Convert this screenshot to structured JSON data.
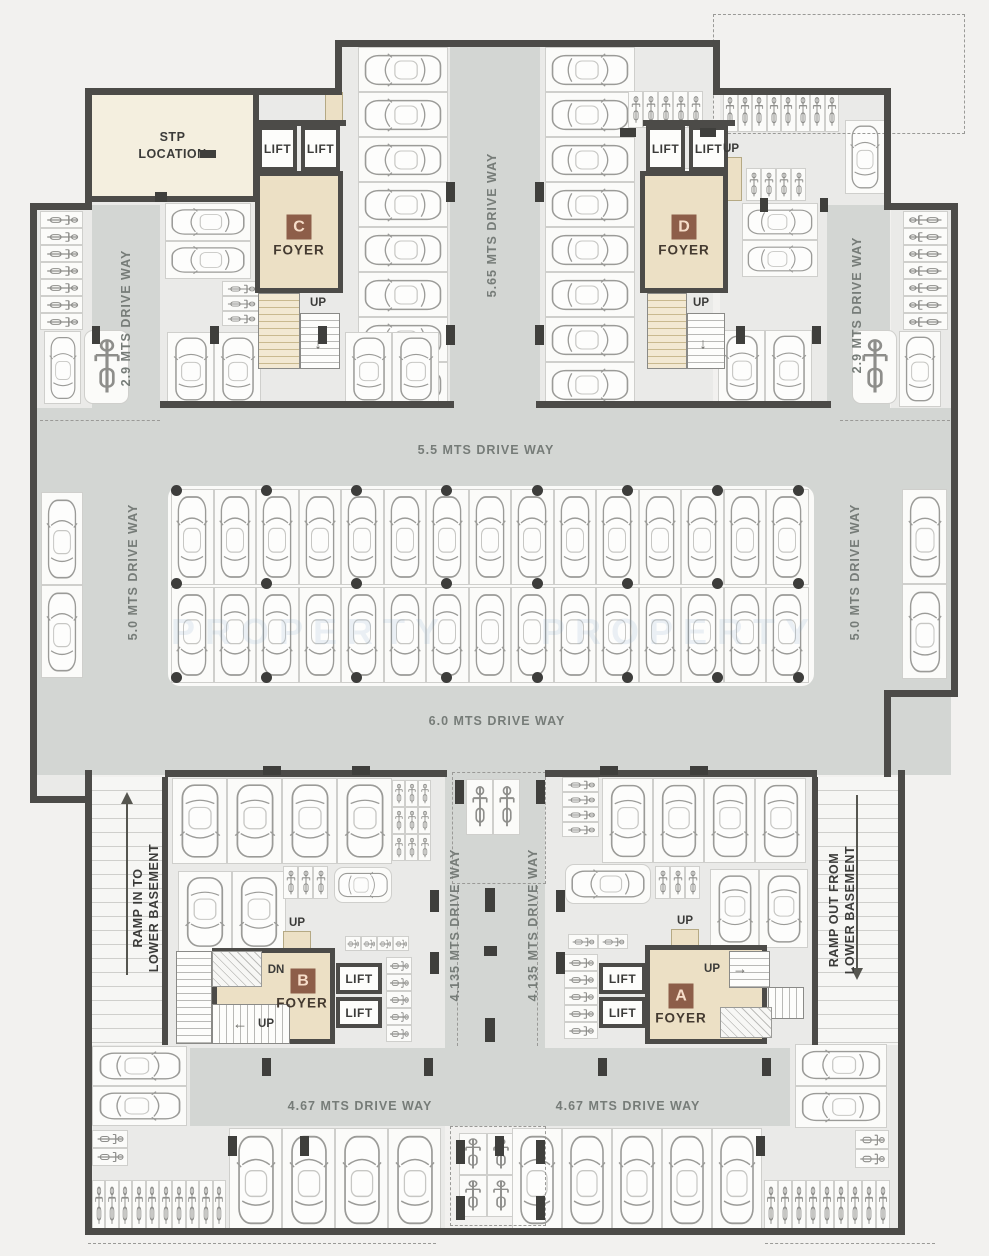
{
  "labels": {
    "stp_line1": "STP",
    "stp_line2": "LOCATION",
    "lift": "LIFT",
    "up": "UP",
    "dn": "DN",
    "foyer": "FOYER",
    "badges": {
      "a": "A",
      "b": "B",
      "c": "C",
      "d": "D"
    },
    "driveways": {
      "d565": "5.65 MTS DRIVE WAY",
      "d29_left": "2.9 MTS DRIVE WAY",
      "d29_right": "2.9 MTS DRIVE WAY",
      "d55": "5.5 MTS DRIVE WAY",
      "d50_left": "5.0 MTS DRIVE WAY",
      "d50_right": "5.0 MTS DRIVE WAY",
      "d60": "6.0 MTS DRIVE WAY",
      "d4135_left": "4.135 MTS DRIVE WAY",
      "d4135_right": "4.135 MTS DRIVE WAY",
      "d467_left": "4.67 MTS DRIVE WAY",
      "d467_right": "4.67 MTS DRIVE WAY"
    },
    "ramp_in": {
      "line1": "RAMP IN TO",
      "line2": "LOWER BASEMENT"
    },
    "ramp_out": {
      "line1": "RAMP OUT FROM",
      "line2": "LOWER BASEMENT"
    },
    "watermark": "PROPERTY"
  },
  "icons": {
    "arrow_up": "↑",
    "arrow_down": "↓",
    "arrow_left": "←",
    "arrow_right": "→"
  },
  "colors": {
    "wall": "#4c4b48",
    "driveway": "#d3d6d3",
    "foyer": "#ece0c5",
    "badge": "#8d5e49",
    "floor": "#eaeae8",
    "stall": "#fbfbf9",
    "driveway_text": "#767c78",
    "label_text": "#3b3b39"
  },
  "parking": [
    {
      "x": 358,
      "y": 47,
      "cols": 1,
      "rows": 8,
      "w": 90,
      "h": 45,
      "icon": "car",
      "rot": 270
    },
    {
      "x": 545,
      "y": 47,
      "cols": 1,
      "rows": 8,
      "w": 90,
      "h": 45,
      "icon": "car",
      "rot": 90
    },
    {
      "x": 628,
      "y": 91,
      "cols": 5,
      "rows": 1,
      "w": 15,
      "h": 37,
      "icon": "bike",
      "rot": 0
    },
    {
      "x": 646,
      "y": 168,
      "cols": 4,
      "rows": 1,
      "w": 15,
      "h": 33,
      "icon": "bike",
      "rot": 0
    },
    {
      "x": 165,
      "y": 203,
      "cols": 1,
      "rows": 2,
      "w": 86,
      "h": 38,
      "icon": "car",
      "rot": 270
    },
    {
      "x": 222,
      "y": 281,
      "cols": 1,
      "rows": 3,
      "w": 38,
      "h": 15,
      "icon": "bike",
      "rot": 90
    },
    {
      "x": 167,
      "y": 332,
      "cols": 2,
      "rows": 1,
      "w": 47,
      "h": 74,
      "icon": "car",
      "rot": 0
    },
    {
      "x": 345,
      "y": 332,
      "cols": 2,
      "rows": 1,
      "w": 47,
      "h": 74,
      "icon": "car",
      "rot": 0
    },
    {
      "x": 40,
      "y": 211,
      "cols": 1,
      "rows": 7,
      "w": 43,
      "h": 17,
      "icon": "bike",
      "rot": 90
    },
    {
      "x": 44,
      "y": 331,
      "cols": 1,
      "rows": 1,
      "w": 37,
      "h": 73,
      "icon": "car",
      "rot": 0
    },
    {
      "x": 84,
      "y": 330,
      "cols": 1,
      "rows": 1,
      "w": 45,
      "h": 74,
      "icon": "bike",
      "rot": 0,
      "round": true
    },
    {
      "x": 41,
      "y": 492,
      "cols": 1,
      "rows": 2,
      "w": 42,
      "h": 93,
      "icon": "car",
      "rot": 0
    },
    {
      "x": 171,
      "y": 489,
      "cols": 15,
      "rows": 1,
      "w": 42.5,
      "h": 96,
      "icon": "car",
      "rot": 0
    },
    {
      "x": 171,
      "y": 587,
      "cols": 15,
      "rows": 1,
      "w": 42.5,
      "h": 96,
      "icon": "car",
      "rot": 180
    },
    {
      "x": 903,
      "y": 211,
      "cols": 1,
      "rows": 7,
      "w": 45,
      "h": 17,
      "icon": "bike",
      "rot": 270
    },
    {
      "x": 899,
      "y": 331,
      "cols": 1,
      "rows": 1,
      "w": 42,
      "h": 76,
      "icon": "car",
      "rot": 0
    },
    {
      "x": 852,
      "y": 330,
      "cols": 1,
      "rows": 1,
      "w": 45,
      "h": 74,
      "icon": "bike",
      "rot": 0,
      "round": true
    },
    {
      "x": 902,
      "y": 489,
      "cols": 1,
      "rows": 2,
      "w": 45,
      "h": 95,
      "icon": "car",
      "rot": 0
    },
    {
      "x": 723,
      "y": 92,
      "cols": 8,
      "rows": 1,
      "w": 14.5,
      "h": 40,
      "icon": "bike",
      "rot": 0
    },
    {
      "x": 845,
      "y": 120,
      "cols": 1,
      "rows": 1,
      "w": 40,
      "h": 74,
      "icon": "car",
      "rot": 0
    },
    {
      "x": 746,
      "y": 168,
      "cols": 4,
      "rows": 1,
      "w": 15,
      "h": 33,
      "icon": "bike",
      "rot": 0
    },
    {
      "x": 742,
      "y": 203,
      "cols": 1,
      "rows": 2,
      "w": 76,
      "h": 37,
      "icon": "car",
      "rot": 90
    },
    {
      "x": 718,
      "y": 330,
      "cols": 2,
      "rows": 1,
      "w": 47,
      "h": 76,
      "icon": "car",
      "rot": 0
    },
    {
      "x": 172,
      "y": 778,
      "cols": 4,
      "rows": 1,
      "w": 55,
      "h": 86,
      "icon": "car",
      "rot": 180
    },
    {
      "x": 392,
      "y": 780,
      "cols": 3,
      "rows": 3,
      "w": 13,
      "h": 27,
      "icon": "bike",
      "rot": 0
    },
    {
      "x": 178,
      "y": 871,
      "cols": 2,
      "rows": 1,
      "w": 54,
      "h": 82,
      "icon": "car",
      "rot": 180
    },
    {
      "x": 283,
      "y": 866,
      "cols": 3,
      "rows": 1,
      "w": 15,
      "h": 33,
      "icon": "bike",
      "rot": 0
    },
    {
      "x": 334,
      "y": 867,
      "cols": 1,
      "rows": 1,
      "w": 58,
      "h": 36,
      "icon": "car",
      "rot": 90,
      "round": true
    },
    {
      "x": 345,
      "y": 936,
      "cols": 4,
      "rows": 1,
      "w": 16,
      "h": 15,
      "icon": "bike",
      "rot": 90
    },
    {
      "x": 386,
      "y": 957,
      "cols": 1,
      "rows": 5,
      "w": 26,
      "h": 17,
      "icon": "bike",
      "rot": 90
    },
    {
      "x": 466,
      "y": 779,
      "cols": 2,
      "rows": 1,
      "w": 27,
      "h": 56,
      "icon": "bike",
      "rot": 0
    },
    {
      "x": 562,
      "y": 777,
      "cols": 1,
      "rows": 4,
      "w": 37,
      "h": 15,
      "icon": "bike",
      "rot": 90
    },
    {
      "x": 602,
      "y": 778,
      "cols": 4,
      "rows": 1,
      "w": 51,
      "h": 85,
      "icon": "car",
      "rot": 180
    },
    {
      "x": 655,
      "y": 866,
      "cols": 3,
      "rows": 1,
      "w": 15,
      "h": 33,
      "icon": "bike",
      "rot": 0
    },
    {
      "x": 565,
      "y": 864,
      "cols": 1,
      "rows": 1,
      "w": 86,
      "h": 40,
      "icon": "car",
      "rot": 270,
      "round": true
    },
    {
      "x": 710,
      "y": 869,
      "cols": 2,
      "rows": 1,
      "w": 49,
      "h": 79,
      "icon": "car",
      "rot": 180
    },
    {
      "x": 568,
      "y": 934,
      "cols": 2,
      "rows": 1,
      "w": 30,
      "h": 15,
      "icon": "bike",
      "rot": 90
    },
    {
      "x": 564,
      "y": 954,
      "cols": 1,
      "rows": 5,
      "w": 34,
      "h": 17,
      "icon": "bike",
      "rot": 90
    },
    {
      "x": 92,
      "y": 1046,
      "cols": 1,
      "rows": 2,
      "w": 95,
      "h": 40,
      "icon": "car",
      "rot": 90
    },
    {
      "x": 92,
      "y": 1130,
      "cols": 1,
      "rows": 2,
      "w": 36,
      "h": 18,
      "icon": "bike",
      "rot": 90
    },
    {
      "x": 92,
      "y": 1180,
      "cols": 10,
      "rows": 1,
      "w": 13.4,
      "h": 52,
      "icon": "bike",
      "rot": 0
    },
    {
      "x": 229,
      "y": 1128,
      "cols": 4,
      "rows": 1,
      "w": 53,
      "h": 104,
      "icon": "car",
      "rot": 0
    },
    {
      "x": 459,
      "y": 1133,
      "cols": 2,
      "rows": 2,
      "w": 28,
      "h": 42,
      "icon": "bike",
      "rot": 0
    },
    {
      "x": 512,
      "y": 1128,
      "cols": 5,
      "rows": 1,
      "w": 50,
      "h": 104,
      "icon": "car",
      "rot": 0
    },
    {
      "x": 764,
      "y": 1180,
      "cols": 9,
      "rows": 1,
      "w": 14,
      "h": 52,
      "icon": "bike",
      "rot": 0
    },
    {
      "x": 795,
      "y": 1044,
      "cols": 1,
      "rows": 2,
      "w": 92,
      "h": 42,
      "icon": "car",
      "rot": 270
    },
    {
      "x": 855,
      "y": 1130,
      "cols": 1,
      "rows": 2,
      "w": 34,
      "h": 19,
      "icon": "bike",
      "rot": 90
    }
  ],
  "walls": [
    [
      335,
      40,
      385,
      7
    ],
    [
      335,
      40,
      7,
      55
    ],
    [
      85,
      88,
      257,
      7
    ],
    [
      85,
      88,
      7,
      122
    ],
    [
      30,
      203,
      62,
      7
    ],
    [
      30,
      203,
      7,
      600
    ],
    [
      30,
      796,
      60,
      7
    ],
    [
      85,
      770,
      7,
      465
    ],
    [
      85,
      1228,
      820,
      7
    ],
    [
      898,
      770,
      7,
      465
    ],
    [
      884,
      88,
      7,
      122
    ],
    [
      713,
      40,
      7,
      55
    ],
    [
      713,
      88,
      178,
      7
    ],
    [
      884,
      203,
      74,
      7
    ],
    [
      951,
      203,
      7,
      494
    ],
    [
      884,
      690,
      74,
      7
    ],
    [
      884,
      690,
      7,
      87
    ],
    [
      160,
      401,
      182,
      7
    ],
    [
      713,
      401,
      118,
      7
    ],
    [
      342,
      401,
      112,
      7
    ],
    [
      536,
      401,
      180,
      7
    ],
    [
      165,
      770,
      282,
      7
    ],
    [
      545,
      770,
      272,
      7
    ],
    [
      162,
      777,
      6,
      268
    ],
    [
      812,
      777,
      6,
      268
    ],
    [
      92,
      196,
      168,
      6
    ],
    [
      253,
      95,
      6,
      107
    ],
    [
      253,
      120,
      93,
      6
    ],
    [
      643,
      120,
      92,
      6
    ]
  ],
  "columns": [
    [
      155,
      192,
      12,
      10
    ],
    [
      200,
      150,
      16,
      8
    ],
    [
      446,
      182,
      9,
      20
    ],
    [
      535,
      182,
      9,
      20
    ],
    [
      446,
      325,
      9,
      20
    ],
    [
      535,
      325,
      9,
      20
    ],
    [
      620,
      128,
      16,
      9
    ],
    [
      700,
      128,
      16,
      9
    ],
    [
      92,
      326,
      8,
      18
    ],
    [
      210,
      326,
      9,
      18
    ],
    [
      318,
      326,
      9,
      18
    ],
    [
      736,
      326,
      9,
      18
    ],
    [
      812,
      326,
      9,
      18
    ],
    [
      760,
      198,
      8,
      14
    ],
    [
      820,
      198,
      8,
      14
    ],
    [
      263,
      766,
      18,
      9
    ],
    [
      352,
      766,
      18,
      9
    ],
    [
      600,
      766,
      18,
      9
    ],
    [
      690,
      766,
      18,
      9
    ],
    [
      455,
      780,
      9,
      24
    ],
    [
      536,
      780,
      9,
      24
    ],
    [
      485,
      888,
      10,
      24
    ],
    [
      484,
      946,
      13,
      10
    ],
    [
      485,
      1018,
      10,
      24
    ],
    [
      430,
      890,
      9,
      22
    ],
    [
      556,
      890,
      9,
      22
    ],
    [
      430,
      952,
      9,
      22
    ],
    [
      556,
      952,
      9,
      22
    ],
    [
      262,
      1058,
      9,
      18
    ],
    [
      424,
      1058,
      9,
      18
    ],
    [
      598,
      1058,
      9,
      18
    ],
    [
      762,
      1058,
      9,
      18
    ],
    [
      228,
      1136,
      9,
      20
    ],
    [
      300,
      1136,
      9,
      20
    ],
    [
      495,
      1136,
      9,
      20
    ],
    [
      756,
      1136,
      9,
      20
    ],
    [
      456,
      1140,
      9,
      24
    ],
    [
      536,
      1140,
      9,
      24
    ],
    [
      456,
      1196,
      9,
      24
    ],
    [
      536,
      1196,
      9,
      24
    ]
  ],
  "island_dots": {
    "xs": [
      176,
      266,
      356,
      446,
      537,
      627,
      717,
      798
    ],
    "ys": [
      490,
      583,
      677
    ]
  }
}
